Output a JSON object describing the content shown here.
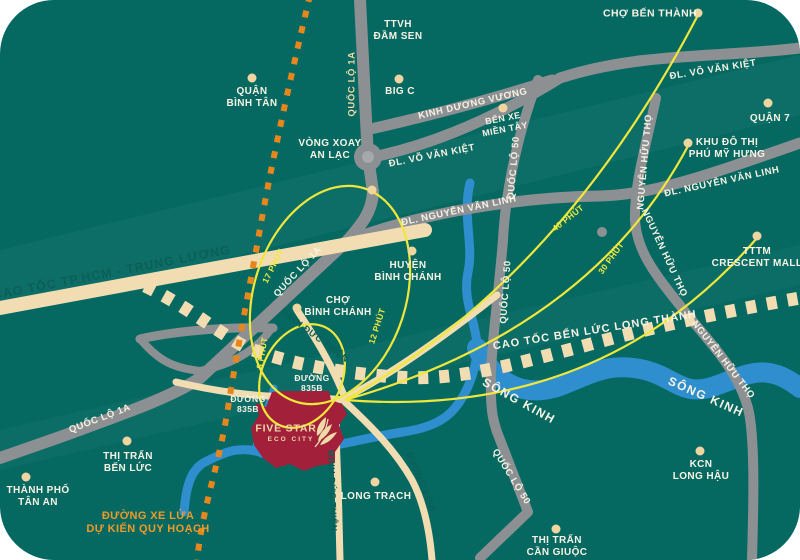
{
  "colors": {
    "map_background": "#056962",
    "road_gray": "#8D9092",
    "road_cream": "#F2DDB2",
    "railway_orange": "#E6861C",
    "route_yellow": "#EFE73B",
    "river_blue": "#2E8ECE",
    "city_red": "#A22039",
    "label_white": "#F7F3E4",
    "label_teal": "#0B5F57",
    "marker_cream": "#EFD6A0"
  },
  "places": {
    "quan_binh_tan": {
      "lines": [
        "QUẬN",
        "BÌNH TÂN"
      ]
    },
    "ttvh_dam_sen": {
      "lines": [
        "TTVH",
        "ĐẦM SEN"
      ]
    },
    "big_c": {
      "lines": [
        "BIG C"
      ]
    },
    "cho_ben_thanh": {
      "lines": [
        "CHỢ BẾN THÀNH"
      ]
    },
    "ben_xe_mien_tay": {
      "lines": [
        "BẾN XE",
        "MIỀN TÂY"
      ]
    },
    "quan_7": {
      "lines": [
        "QUẬN 7"
      ]
    },
    "khu_do_thi_phu_my_hung": {
      "lines": [
        "KHU ĐÔ THỊ",
        "PHÚ MỸ HƯNG"
      ]
    },
    "vong_xoay_an_lac": {
      "lines": [
        "VÒNG XOAY",
        "AN LẠC"
      ]
    },
    "huyen_binh_chanh": {
      "lines": [
        "HUYỆN",
        "BÌNH CHÁNH"
      ]
    },
    "tttm_crescent_mall": {
      "lines": [
        "TTTM",
        "CRESCENT MALL"
      ]
    },
    "cho_binh_chanh": {
      "lines": [
        "CHỢ",
        "BÌNH CHÁNH"
      ]
    },
    "thi_tran_ben_luc": {
      "lines": [
        "THỊ TRẤN",
        "BẾN LỨC"
      ]
    },
    "thanh_pho_tan_an": {
      "lines": [
        "THÀNH PHỐ",
        "TÂN AN"
      ]
    },
    "long_trach": {
      "lines": [
        "LONG TRẠCH"
      ]
    },
    "kcn_long_hau": {
      "lines": [
        "KCN",
        "LONG HẬU"
      ]
    },
    "thi_tran_can_giuoc": {
      "lines": [
        "THỊ TRẤN",
        "CẦN GIUỘC"
      ]
    }
  },
  "roads": {
    "quoc_lo_1a": "QUỐC LỘ 1A",
    "kinh_duong_vuong": "KINH DƯƠNG VƯƠNG",
    "vo_van_kiet": "ĐL. VÕ VĂN KIỆT",
    "nguyen_van_linh": "ĐL. NGUYỄN VĂN LINH",
    "quoc_lo_50": "QUỐC LỘ 50",
    "nguyen_huu_tho": "NGUYỄN HỮU THỌ",
    "cao_toc_hcm_trung_luong": "CAO TỐC TP.HCM - TRUNG LƯƠNG",
    "cao_toc_ben_luc_long_thanh": "CAO TỐC BẾN LỨC LONG THÀNH",
    "dinh_duc_thien": "ĐINH ĐỨC THIỆN",
    "duong_835b_single": "ĐƯỜNG 835B",
    "duong_835b": {
      "lines": [
        "ĐƯỜNG",
        "835B"
      ]
    }
  },
  "rivers": {
    "song_kinh": "SÔNG KINH"
  },
  "railway_label": {
    "lines": [
      "ĐƯỜNG XE LỬA",
      "DỰ KIẾN QUY HOẠCH"
    ]
  },
  "travel_times": {
    "t17": "17 PHÚT",
    "t12": "12 PHÚT",
    "t8": "8 PHÚT",
    "t40": "40 PHÚT",
    "t30": "30 PHÚT"
  },
  "city": {
    "line1": "FIVE STAR",
    "line2": "ECO CITY"
  }
}
